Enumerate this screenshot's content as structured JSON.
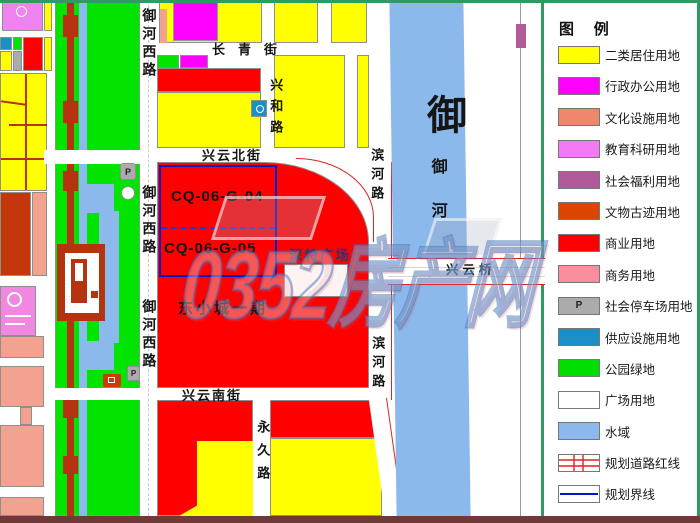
{
  "legend": {
    "title": "图 例",
    "items": [
      {
        "label": "二类居住用地",
        "color": "#ffff00",
        "type": "swatch"
      },
      {
        "label": "行政办公用地",
        "color": "#ff00ff",
        "type": "swatch"
      },
      {
        "label": "文化设施用地",
        "color": "#f0876b",
        "type": "swatch"
      },
      {
        "label": "教育科研用地",
        "color": "#f47af4",
        "type": "swatch"
      },
      {
        "label": "社会福利用地",
        "color": "#b05a9a",
        "type": "swatch"
      },
      {
        "label": "文物古迹用地",
        "color": "#dd4400",
        "type": "swatch"
      },
      {
        "label": "商业用地",
        "color": "#ff0000",
        "type": "swatch"
      },
      {
        "label": "商务用地",
        "color": "#fa8e9e",
        "type": "swatch"
      },
      {
        "label": "社会停车场用地",
        "color": "#ababab",
        "type": "parking"
      },
      {
        "label": "供应设施用地",
        "color": "#1b8fc6",
        "type": "swatch"
      },
      {
        "label": "公园绿地",
        "color": "#00dd00",
        "type": "swatch"
      },
      {
        "label": "广场用地",
        "color": "#ffffff",
        "type": "swatch"
      },
      {
        "label": "水域",
        "color": "#8cb9ec",
        "type": "swatch"
      },
      {
        "label": "规划道路红线",
        "color": "#e22222",
        "type": "road-redline"
      },
      {
        "label": "规划界线",
        "color": "#0015cc",
        "type": "boundary-line"
      }
    ]
  },
  "map": {
    "streets": {
      "changqing": "长青街",
      "xinghe": "兴和路",
      "xingyun_north": "兴云北街",
      "xingyun_south": "兴云南街",
      "yuhe_west": "御河西路",
      "binhe": "滨河路",
      "yongjiu": "永久路",
      "xingyun_bridge": "兴云桥"
    },
    "river": {
      "big": "御",
      "small": "御河"
    },
    "zones": {
      "cq04": "CQ-06-G-04",
      "cq05": "CQ-06-G-05",
      "dongxiaocheng": "东小城一期",
      "plaza": "深特广场"
    },
    "symbols": {
      "parking": "P"
    }
  },
  "watermark": {
    "text": "0352房产网"
  }
}
